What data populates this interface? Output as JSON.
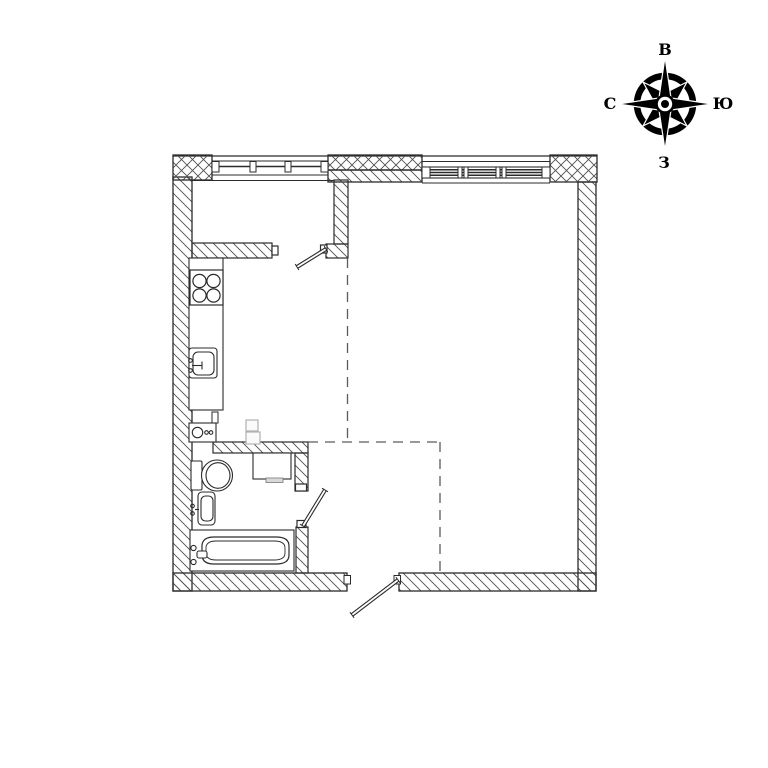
{
  "page": {
    "background": "#ffffff"
  },
  "colors": {
    "line": "#2b2b2b",
    "hatch": "#4f4f4f",
    "dashed_boundary": "#5a5a5a",
    "faint": "#b0b0b0",
    "compass": "#000000"
  },
  "compass": {
    "labels": {
      "top": "В",
      "right": "Ю",
      "bottom": "З",
      "left": "С"
    }
  },
  "plan": {
    "windows": [
      "kitchen-window",
      "living-room-window"
    ],
    "doors": [
      "kitchen-door",
      "bathroom-door",
      "entry-door"
    ],
    "fixtures": [
      "stove-icon",
      "kitchen-sink-icon",
      "boiler-icon",
      "duct-icon",
      "washing-machine-icon",
      "toilet-icon",
      "washbasin-icon",
      "bathtub-icon"
    ],
    "zone_boundary": "dashed-line"
  }
}
